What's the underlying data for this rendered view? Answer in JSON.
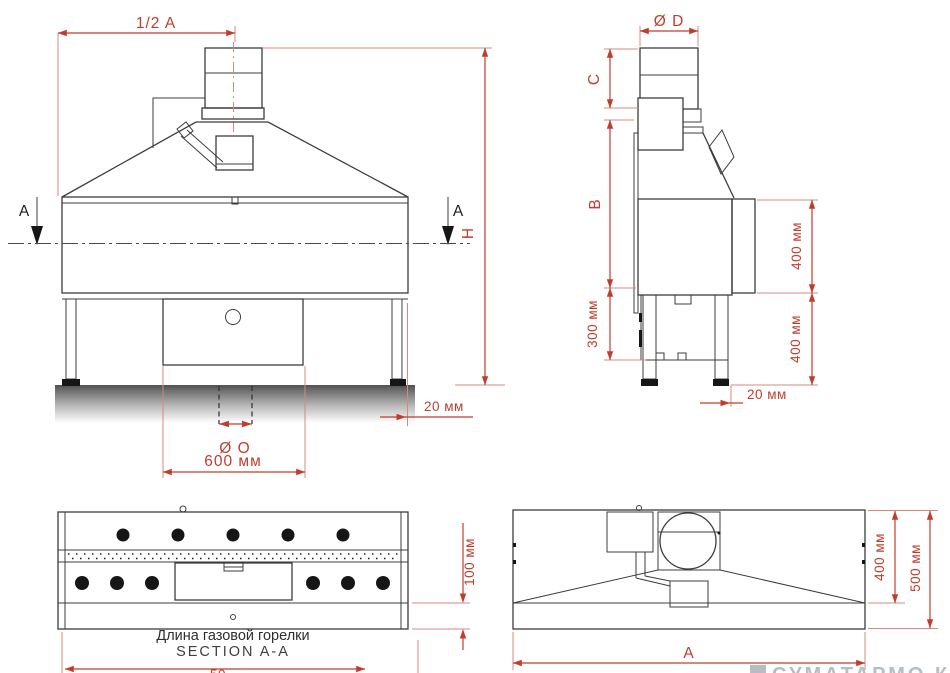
{
  "colors": {
    "dimension_red": "#c03d2e",
    "extension_pink": "#d6887e",
    "line_dark": "#3c3c3c",
    "fill_black": "#161616",
    "caption": "#2e2e2e",
    "watermark_gray": "#b7bdc4"
  },
  "front_view": {
    "labels": {
      "half_a": "1/2 A",
      "section_a": "A",
      "height_h": "H",
      "dia_o": "Ø O",
      "width_600": "600 мм",
      "offset_20": "20 мм"
    }
  },
  "side_view": {
    "labels": {
      "dia_d": "Ø D",
      "c": "C",
      "b": "B",
      "h_300": "300 мм",
      "h_400_top": "400 мм",
      "h_400_bottom": "400 мм",
      "offset_20": "20 мм"
    }
  },
  "section_view": {
    "caption_ru": "Длина газовой горелки",
    "caption_en": "SECTION A-A",
    "strip_100": "100 мм",
    "cropped_dim": "50"
  },
  "top_view": {
    "labels": {
      "depth_400": "400 мм",
      "depth_500": "500 мм",
      "width_a": "A"
    }
  },
  "watermark": {
    "text": "СУМАТАРМО.КМ"
  }
}
